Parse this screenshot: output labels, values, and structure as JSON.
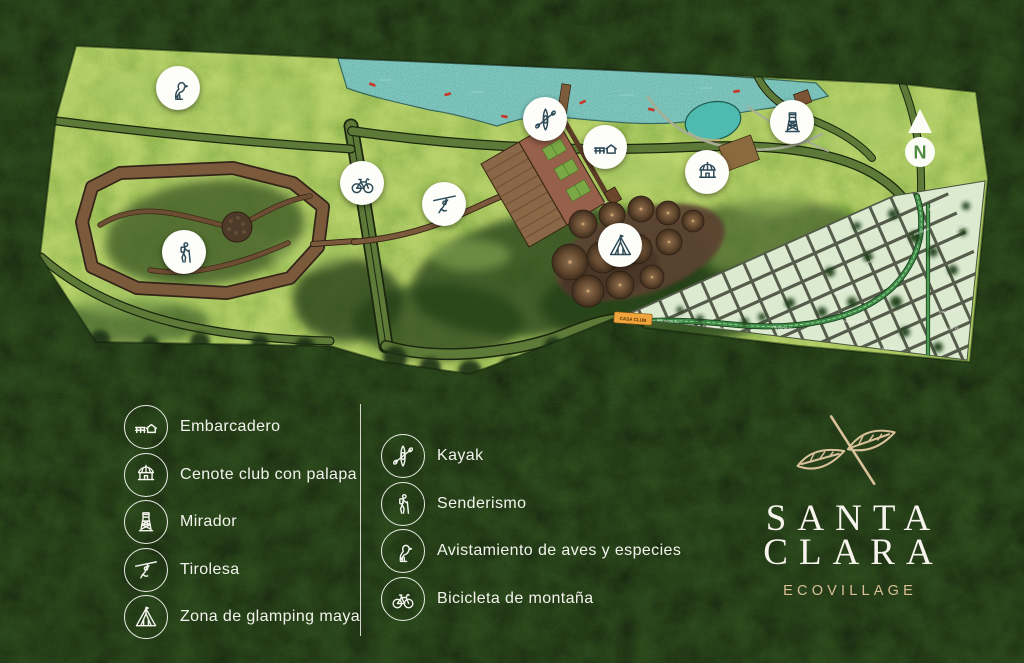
{
  "brand": {
    "name_line1": "SANTA",
    "name_line2": "CLARA",
    "subtitle": "ECOVILLAGE"
  },
  "compass": {
    "label": "N"
  },
  "map": {
    "casa_club_label": "CASA CLUB",
    "street_labels": [
      "PRIVADA 2",
      "PRIVADA 4",
      "PRIVADA 5",
      "PRIVADA 7",
      "PRIVADA 8",
      "PRIVADA 10",
      "PRIVADA 12",
      "PRIVADA 13",
      "PRIVADA 14",
      "PRIVADA 15",
      "PRIVADA 16",
      "PRIVADA 17"
    ],
    "markers": [
      {
        "name": "avistamiento-de-aves",
        "icon": "bird-icon"
      },
      {
        "name": "bicicleta-de-montana",
        "icon": "bicycle-icon"
      },
      {
        "name": "tirolesa",
        "icon": "zipline-icon"
      },
      {
        "name": "senderismo",
        "icon": "hiker-icon"
      },
      {
        "name": "kayak",
        "icon": "kayak-icon"
      },
      {
        "name": "embarcadero",
        "icon": "dock-icon"
      },
      {
        "name": "cenote-club-con-palapa",
        "icon": "palapa-icon"
      },
      {
        "name": "mirador",
        "icon": "watchtower-icon"
      },
      {
        "name": "zona-de-glamping-maya",
        "icon": "tent-icon"
      }
    ]
  },
  "legend": {
    "column1": [
      {
        "icon": "dock-icon",
        "label": "Embarcadero"
      },
      {
        "icon": "palapa-icon",
        "label": "Cenote club con palapa"
      },
      {
        "icon": "watchtower-icon",
        "label": "Mirador"
      },
      {
        "icon": "zipline-icon",
        "label": "Tirolesa"
      },
      {
        "icon": "tent-icon",
        "label": "Zona de glamping maya"
      }
    ],
    "column2": [
      {
        "icon": "kayak-icon",
        "label": "Kayak"
      },
      {
        "icon": "hiker-icon",
        "label": "Senderismo"
      },
      {
        "icon": "bird-icon",
        "label": "Avistamiento de aves y especies"
      },
      {
        "icon": "bicycle-icon",
        "label": "Bicicleta de montaña"
      }
    ]
  },
  "colors": {
    "logo_gold": "#d9c29a",
    "water_teal": "#55c3b7",
    "casa_club_orange": "#f0a43c",
    "marker_icon_ink": "#2c4a57",
    "legend_text": "#f2f3ec",
    "jungle_dark": "#16250e",
    "map_green": "#7ca943"
  }
}
